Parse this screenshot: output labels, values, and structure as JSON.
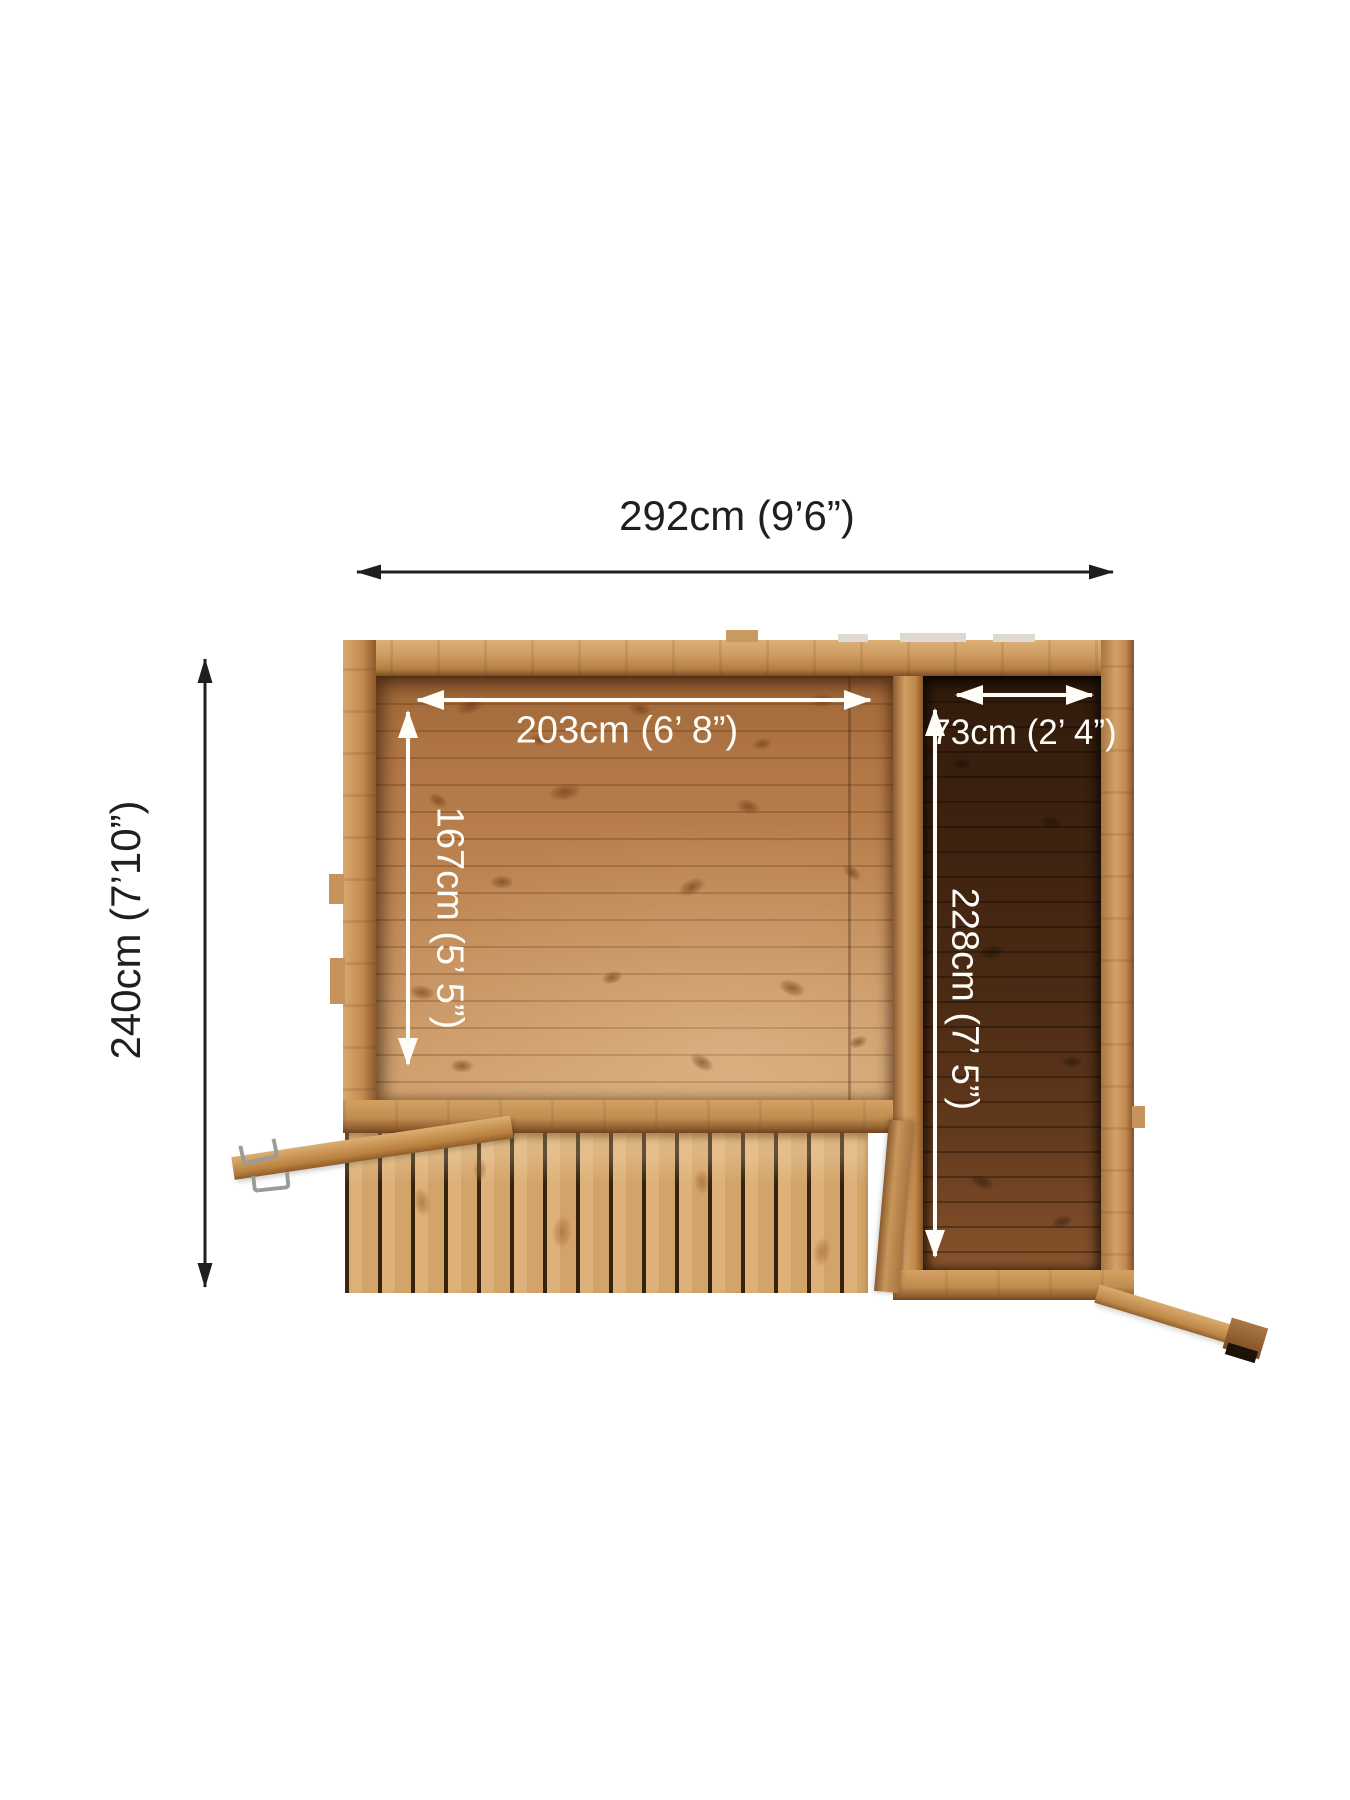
{
  "labels": {
    "overall_width": "292cm (9’6”)",
    "overall_depth": "240cm (7’10”)",
    "main_internal_width": "203cm (6’ 8”)",
    "main_internal_depth": "167cm (5’ 5”)",
    "side_internal_width": "73cm (2’ 4”)",
    "side_internal_depth": "228cm (7’ 5”)"
  },
  "colors": {
    "background": "#ffffff",
    "annotation_black": "#1f1f1f",
    "annotation_white": "#fffdf8",
    "wood_frame": "#cb975d",
    "wood_floor_main": "#b9824e",
    "wood_floor_side_dark": "#42260f",
    "wood_deck": "#ddb179",
    "metal_hook": "#9b9b98"
  }
}
